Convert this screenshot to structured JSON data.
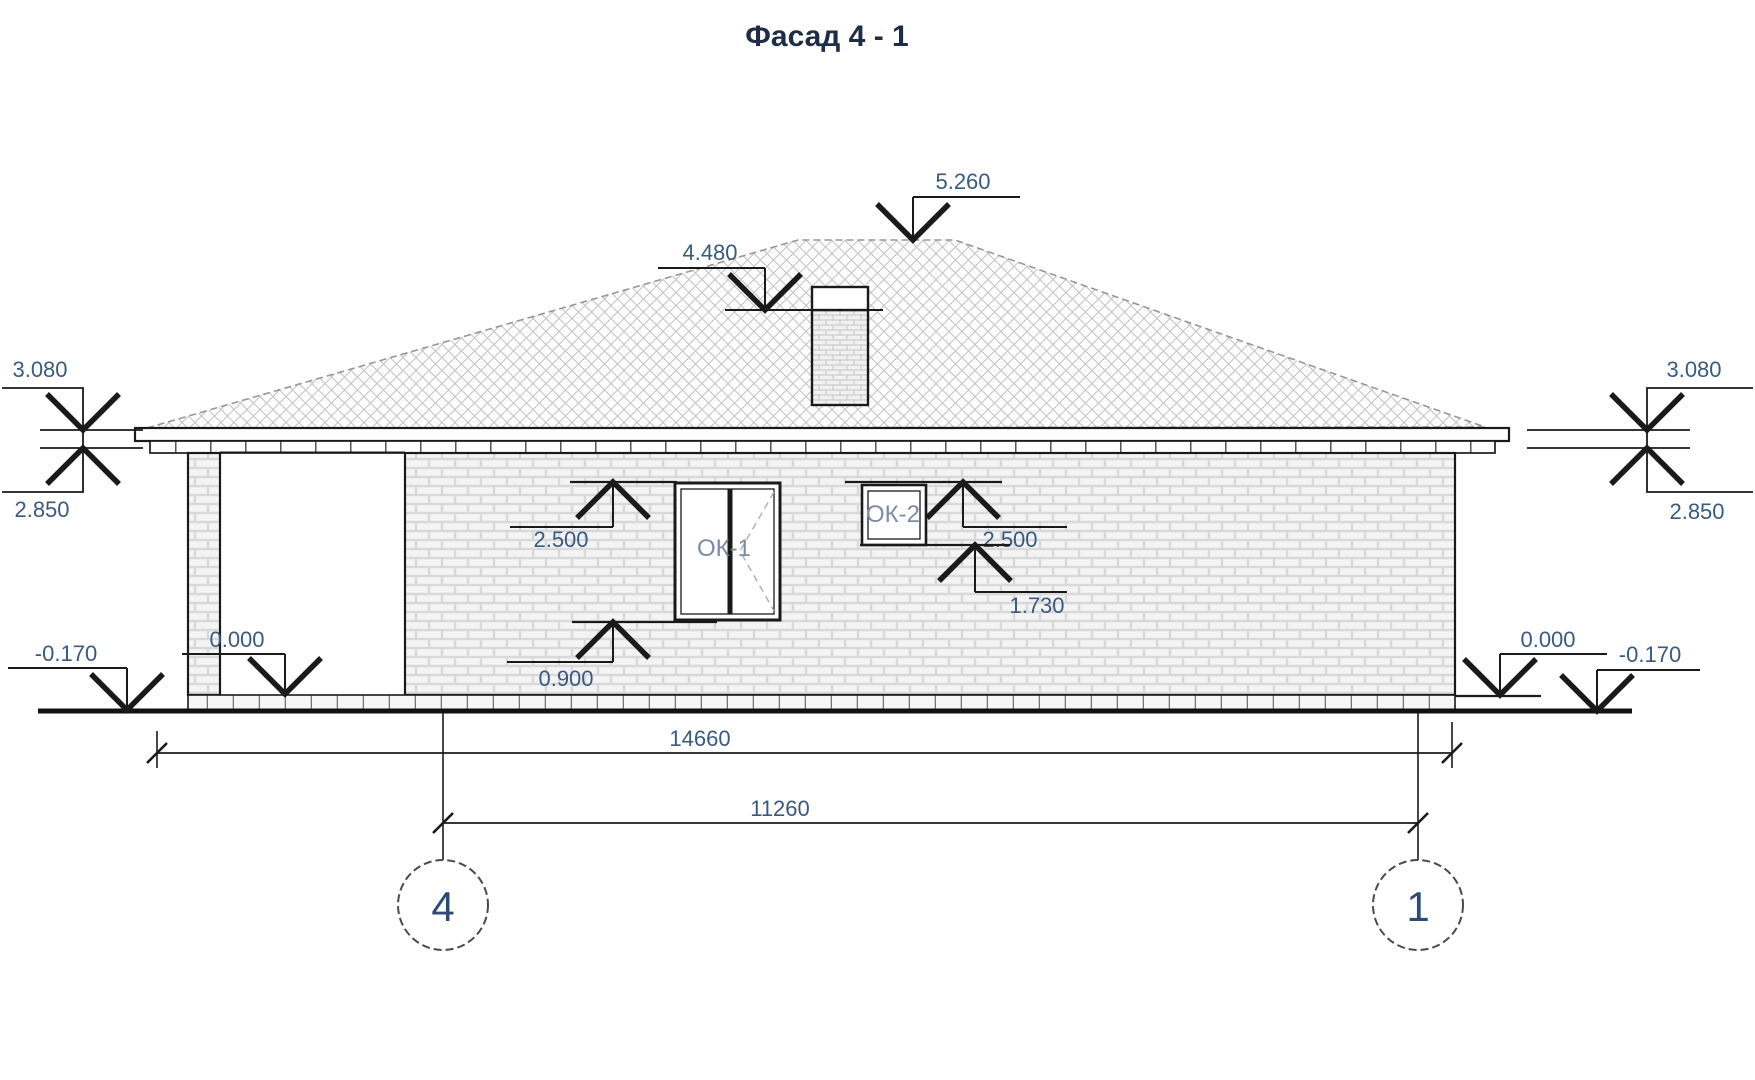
{
  "title": "Фасад 4 - 1",
  "colors": {
    "line": "#1a1a1a",
    "label": "#395a80",
    "window_label": "#7d8ba3",
    "axis_label": "#2d4a73"
  },
  "elevation_marks": {
    "ridge": "5.260",
    "chimney_band": "4.480",
    "left_fascia_top": "3.080",
    "left_wall_top": "2.850",
    "right_fascia_top": "3.080",
    "right_wall_top": "2.850",
    "ok1_head": "2.500",
    "ok1_sill": "0.900",
    "ok2_head": "2.500",
    "ok2_sill": "1.730",
    "left_floor": "0.000",
    "left_ground": "-0.170",
    "right_floor": "0.000",
    "right_ground": "-0.170"
  },
  "windows": {
    "ok1": "ОК-1",
    "ok2": "ОК-2"
  },
  "dimensions": {
    "overall": "14660",
    "axis_span": "11260"
  },
  "axes": {
    "left": "4",
    "right": "1"
  }
}
